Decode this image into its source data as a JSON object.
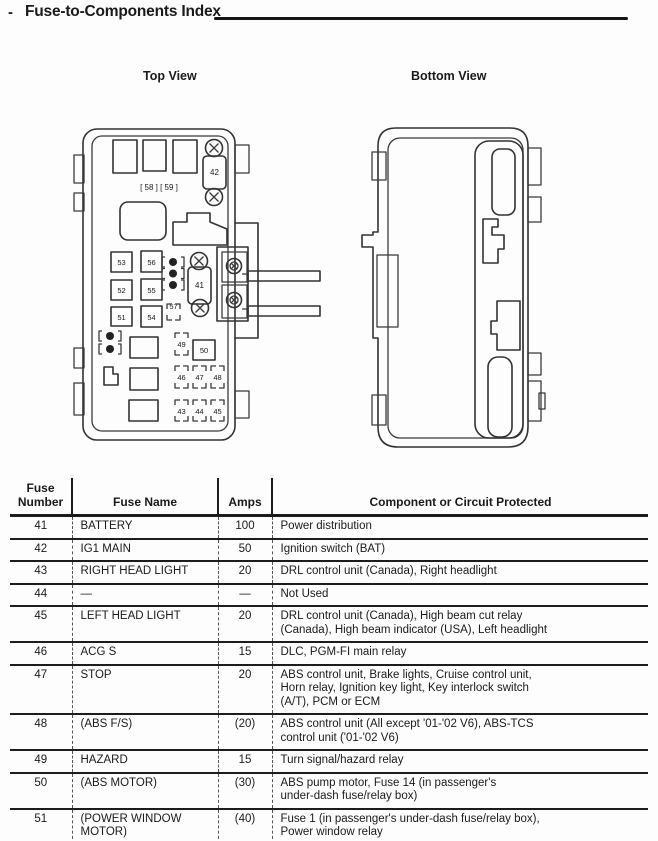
{
  "header": {
    "dash": "-",
    "title": "Fuse-to-Components Index"
  },
  "diagram": {
    "top_view_label": "Top View",
    "bottom_view_label": "Bottom View",
    "top_view": {
      "bracket_label": "[ 58 ] [ 59 ]",
      "fuses": {
        "f41": "41",
        "f42": "42",
        "f43": "43",
        "f44": "44",
        "f45": "45",
        "f46": "46",
        "f47": "47",
        "f48": "48",
        "f49": "49",
        "f50": "50",
        "f51": "51",
        "f52": "52",
        "f53": "53",
        "f54": "54",
        "f55": "55",
        "f56": "56",
        "f57": "57"
      }
    }
  },
  "table": {
    "headers": {
      "number": "Fuse\nNumber",
      "name": "Fuse Name",
      "amps": "Amps",
      "component": "Component or Circuit Protected"
    },
    "rows": [
      {
        "number": "41",
        "name": "BATTERY",
        "amps": "100",
        "component": "Power distribution"
      },
      {
        "number": "42",
        "name": "IG1 MAIN",
        "amps": "50",
        "component": "Ignition switch (BAT)"
      },
      {
        "number": "43",
        "name": "RIGHT HEAD LIGHT",
        "amps": "20",
        "component": "DRL control unit (Canada), Right headlight"
      },
      {
        "number": "44",
        "name": "—",
        "amps": "—",
        "component": "Not Used"
      },
      {
        "number": "45",
        "name": "LEFT HEAD LIGHT",
        "amps": "20",
        "component": "DRL control unit (Canada), High beam cut relay\n(Canada), High beam indicator (USA), Left headlight"
      },
      {
        "number": "46",
        "name": "ACG S",
        "amps": "15",
        "component": "DLC, PGM-FI main relay"
      },
      {
        "number": "47",
        "name": "STOP",
        "amps": "20",
        "component": "ABS control unit, Brake lights, Cruise control unit,\nHorn relay, Ignition key light, Key interlock switch\n(A/T), PCM or ECM"
      },
      {
        "number": "48",
        "name": "(ABS F/S)",
        "amps": "(20)",
        "component": "ABS control unit (All except '01-'02 V6), ABS-TCS\ncontrol unit ('01-'02 V6)"
      },
      {
        "number": "49",
        "name": "HAZARD",
        "amps": "15",
        "component": "Turn signal/hazard relay"
      },
      {
        "number": "50",
        "name": "(ABS MOTOR)",
        "amps": "(30)",
        "component": "ABS pump motor, Fuse 14 (in passenger's\nunder-dash fuse/relay box)"
      },
      {
        "number": "51",
        "name": "(POWER WINDOW\nMOTOR)",
        "amps": "(40)",
        "component": "Fuse 1 (in passenger's under-dash fuse/relay box),\nPower window relay"
      }
    ]
  }
}
